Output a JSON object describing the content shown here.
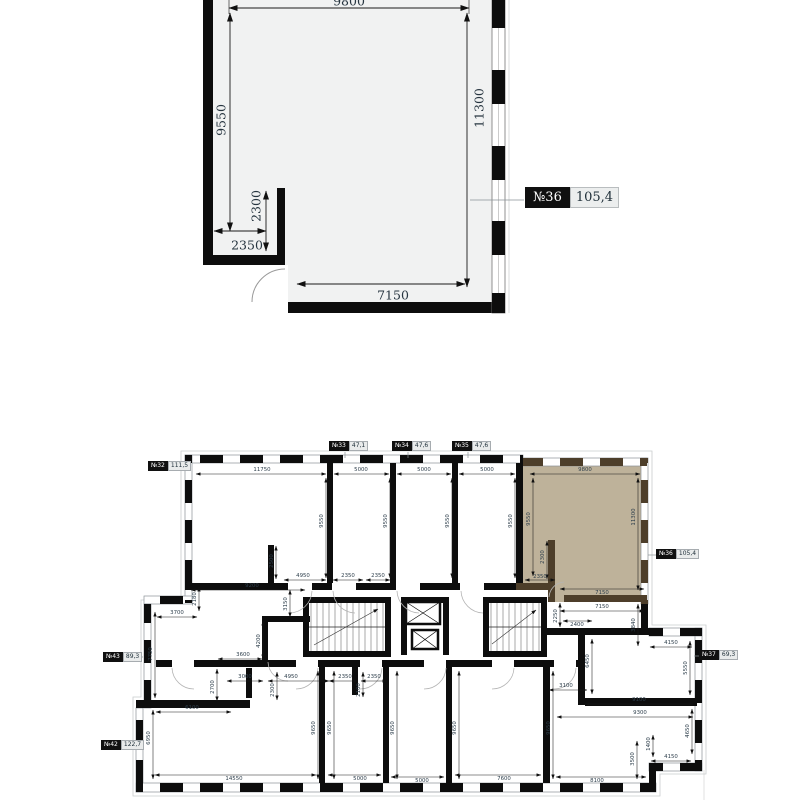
{
  "detail_plan": {
    "unit_label": {
      "number": "№36",
      "area": "105,4"
    },
    "dims": [
      {
        "t": "9800",
        "x": 349,
        "y": 1,
        "l": [
          229,
          8,
          469,
          8
        ]
      },
      {
        "t": "9550",
        "x": 221,
        "y": 120,
        "r": 1,
        "l": [
          230,
          13,
          230,
          231
        ]
      },
      {
        "t": "11300",
        "x": 479,
        "y": 108,
        "r": 1,
        "l": [
          467,
          13,
          467,
          287
        ]
      },
      {
        "t": "2300",
        "x": 256,
        "y": 206,
        "r": 1,
        "l": [
          266,
          191,
          266,
          251
        ]
      },
      {
        "t": "2350",
        "x": 247,
        "y": 245,
        "l": [
          214,
          231,
          266,
          231
        ]
      },
      {
        "t": "7150",
        "x": 393,
        "y": 295,
        "l": [
          297,
          284,
          465,
          284
        ]
      }
    ]
  },
  "floor_plan": {
    "units": [
      {
        "number": "№32",
        "area": "111,5"
      },
      {
        "number": "№33",
        "area": "47,1"
      },
      {
        "number": "№34",
        "area": "47,6"
      },
      {
        "number": "№35",
        "area": "47,6"
      },
      {
        "number": "№36",
        "area": "105,4"
      },
      {
        "number": "№37",
        "area": "69,3"
      },
      {
        "number": "№43",
        "area": "89,3"
      },
      {
        "number": "№42",
        "area": "122,7"
      }
    ],
    "dims": [
      {
        "t": "11750",
        "x": 262,
        "y": 470,
        "l": [
          196,
          474,
          326,
          474
        ]
      },
      {
        "t": "5000",
        "x": 361,
        "y": 470,
        "l": [
          334,
          474,
          389,
          474
        ]
      },
      {
        "t": "5000",
        "x": 424,
        "y": 470,
        "l": [
          397,
          474,
          451,
          474
        ]
      },
      {
        "t": "5000",
        "x": 487,
        "y": 470,
        "l": [
          459,
          474,
          515,
          474
        ]
      },
      {
        "t": "9800",
        "x": 585,
        "y": 470,
        "l": [
          530,
          474,
          640,
          474
        ]
      },
      {
        "t": "9550",
        "x": 322,
        "y": 521,
        "r": 1,
        "l": [
          326,
          478,
          326,
          578
        ]
      },
      {
        "t": "9550",
        "x": 386,
        "y": 521,
        "r": 1,
        "l": [
          390,
          478,
          390,
          578
        ]
      },
      {
        "t": "9550",
        "x": 448,
        "y": 521,
        "r": 1,
        "l": [
          452,
          478,
          452,
          578
        ]
      },
      {
        "t": "9550",
        "x": 511,
        "y": 521,
        "r": 1,
        "l": [
          515,
          478,
          515,
          578
        ]
      },
      {
        "t": "9550",
        "x": 529,
        "y": 519,
        "r": 1,
        "l": [
          533,
          478,
          533,
          576
        ]
      },
      {
        "t": "11300",
        "x": 634,
        "y": 517,
        "r": 1,
        "l": [
          638,
          478,
          638,
          590
        ]
      },
      {
        "t": "2300",
        "x": 543,
        "y": 557,
        "r": 1,
        "l": [
          547,
          541,
          547,
          579
        ]
      },
      {
        "t": "2350",
        "x": 540,
        "y": 577,
        "l": [
          525,
          580,
          555,
          580
        ]
      },
      {
        "t": "7150",
        "x": 602,
        "y": 593,
        "l": [
          560,
          589,
          644,
          589
        ]
      },
      {
        "t": "2500",
        "x": 272,
        "y": 561,
        "r": 1,
        "l": [
          276,
          546,
          276,
          579
        ]
      },
      {
        "t": "4950",
        "x": 303,
        "y": 576,
        "l": [
          284,
          580,
          326,
          580
        ]
      },
      {
        "t": "2350",
        "x": 348,
        "y": 576,
        "l": [
          333,
          580,
          363,
          580
        ]
      },
      {
        "t": "2350",
        "x": 378,
        "y": 576,
        "l": [
          366,
          580,
          390,
          580
        ]
      },
      {
        "t": "9200",
        "x": 252,
        "y": 586,
        "l": [
          191,
          590,
          305,
          590
        ]
      },
      {
        "t": "2180",
        "x": 195,
        "y": 599,
        "r": 1,
        "l": [
          199,
          587,
          199,
          611
        ]
      },
      {
        "t": "3150",
        "x": 286,
        "y": 604,
        "r": 1,
        "l": [
          290,
          590,
          290,
          617
        ]
      },
      {
        "t": "3700",
        "x": 177,
        "y": 613,
        "l": [
          157,
          617,
          197,
          617
        ]
      },
      {
        "t": "7750",
        "x": 151,
        "y": 654,
        "r": 1,
        "l": [
          155,
          612,
          155,
          698
        ]
      },
      {
        "t": "4200",
        "x": 259,
        "y": 641,
        "r": 1,
        "l": [
          263,
          621,
          263,
          659
        ]
      },
      {
        "t": "3600",
        "x": 243,
        "y": 655,
        "l": [
          218,
          659,
          262,
          659
        ]
      },
      {
        "t": "3000",
        "x": 245,
        "y": 677,
        "l": [
          227,
          681,
          263,
          681
        ]
      },
      {
        "t": "2700",
        "x": 213,
        "y": 687,
        "r": 1,
        "l": [
          217,
          669,
          217,
          701
        ]
      },
      {
        "t": "6100",
        "x": 192,
        "y": 708,
        "l": [
          156,
          712,
          231,
          712
        ]
      },
      {
        "t": "4950",
        "x": 291,
        "y": 677,
        "l": [
          268,
          681,
          329,
          681
        ]
      },
      {
        "t": "2300",
        "x": 273,
        "y": 690,
        "r": 1,
        "l": [
          277,
          672,
          277,
          700
        ]
      },
      {
        "t": "2350",
        "x": 345,
        "y": 677,
        "l": [
          329,
          681,
          358,
          681
        ]
      },
      {
        "t": "2350",
        "x": 374,
        "y": 677,
        "l": [
          361,
          681,
          387,
          681
        ]
      },
      {
        "t": "2100",
        "x": 359,
        "y": 690,
        "r": 1,
        "l": [
          363,
          672,
          363,
          697
        ]
      },
      {
        "t": "6950",
        "x": 149,
        "y": 738,
        "r": 1,
        "l": [
          153,
          710,
          153,
          779
        ]
      },
      {
        "t": "9650",
        "x": 314,
        "y": 728,
        "r": 1,
        "l": [
          318,
          671,
          318,
          779
        ]
      },
      {
        "t": "9650",
        "x": 330,
        "y": 728,
        "r": 1,
        "l": [
          334,
          671,
          334,
          779
        ]
      },
      {
        "t": "9650",
        "x": 393,
        "y": 728,
        "r": 1,
        "l": [
          397,
          671,
          397,
          779
        ]
      },
      {
        "t": "9650",
        "x": 455,
        "y": 728,
        "r": 1,
        "l": [
          459,
          671,
          459,
          779
        ]
      },
      {
        "t": "9650",
        "x": 549,
        "y": 728,
        "r": 1,
        "l": [
          553,
          671,
          553,
          779
        ]
      },
      {
        "t": "14550",
        "x": 234,
        "y": 779,
        "l": [
          155,
          775,
          316,
          775
        ]
      },
      {
        "t": "5000",
        "x": 360,
        "y": 779,
        "l": [
          328,
          775,
          381,
          775
        ]
      },
      {
        "t": "5000",
        "x": 422,
        "y": 781,
        "l": [
          391,
          777,
          444,
          777
        ]
      },
      {
        "t": "7600",
        "x": 504,
        "y": 779,
        "l": [
          455,
          775,
          541,
          775
        ]
      },
      {
        "t": "8100",
        "x": 597,
        "y": 781,
        "l": [
          556,
          777,
          646,
          777
        ]
      },
      {
        "t": "7150",
        "x": 602,
        "y": 607,
        "l": [
          560,
          611,
          644,
          611
        ]
      },
      {
        "t": "2250",
        "x": 556,
        "y": 616,
        "r": 1,
        "l": [
          560,
          603,
          560,
          627
        ]
      },
      {
        "t": "2400",
        "x": 577,
        "y": 625,
        "l": [
          563,
          621,
          592,
          621
        ]
      },
      {
        "t": "3840",
        "x": 634,
        "y": 625,
        "r": 1,
        "l": [
          638,
          604,
          638,
          646
        ]
      },
      {
        "t": "4150",
        "x": 671,
        "y": 643,
        "l": [
          650,
          647,
          692,
          647
        ]
      },
      {
        "t": "5550",
        "x": 686,
        "y": 668,
        "r": 1,
        "l": [
          690,
          641,
          690,
          695
        ]
      },
      {
        "t": "6450",
        "x": 588,
        "y": 661,
        "r": 1,
        "l": [
          592,
          639,
          592,
          694
        ]
      },
      {
        "t": "3100",
        "x": 566,
        "y": 686,
        "l": [
          549,
          690,
          587,
          690
        ]
      },
      {
        "t": "9100",
        "x": 639,
        "y": 700,
        "l": [
          585,
          704,
          693,
          704
        ]
      },
      {
        "t": "9300",
        "x": 640,
        "y": 713,
        "l": [
          557,
          717,
          693,
          717
        ]
      },
      {
        "t": "4650",
        "x": 688,
        "y": 731,
        "r": 1,
        "l": [
          692,
          709,
          692,
          754
        ]
      },
      {
        "t": "1400",
        "x": 649,
        "y": 744,
        "r": 1,
        "l": [
          653,
          735,
          653,
          757
        ]
      },
      {
        "t": "3500",
        "x": 633,
        "y": 759,
        "r": 1,
        "l": [
          637,
          741,
          637,
          779
        ]
      },
      {
        "t": "4150",
        "x": 671,
        "y": 757,
        "l": [
          651,
          761,
          691,
          761
        ]
      }
    ]
  },
  "colors": {
    "wall": "#0d0d0d",
    "highlight": "#b5a78c",
    "highlight_wall": "#4d3e2a",
    "dim_text": "#2e3f4c",
    "room_fill": "#f1f2f2",
    "label_box_bg": "#e9ebeb"
  }
}
